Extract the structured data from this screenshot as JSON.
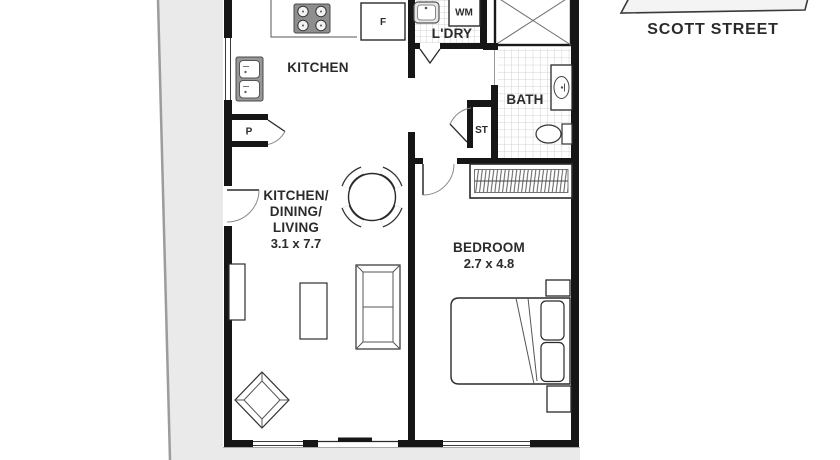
{
  "street": {
    "label": "SCOTT STREET"
  },
  "rooms": {
    "kitchen": {
      "label": "KITCHEN"
    },
    "living": {
      "line1": "KITCHEN/",
      "line2": "DINING/",
      "line3": "LIVING",
      "dims": "3.1 x 7.7"
    },
    "bedroom": {
      "label": "BEDROOM",
      "dims": "2.7 x 4.8"
    },
    "bath": {
      "label": "BATH"
    },
    "laundry": {
      "label": "L'DRY"
    }
  },
  "fixtures": {
    "fridge": "F",
    "washing_machine": "WM",
    "pantry": "P",
    "store": "ST"
  },
  "colors": {
    "wall": "#161616",
    "outside_area": "#eaeaea",
    "outside_edge": "#9c9c9c",
    "tile_line": "#c6c6c6",
    "furniture_line": "#2f2f2f",
    "text": "#2b2b2b"
  }
}
